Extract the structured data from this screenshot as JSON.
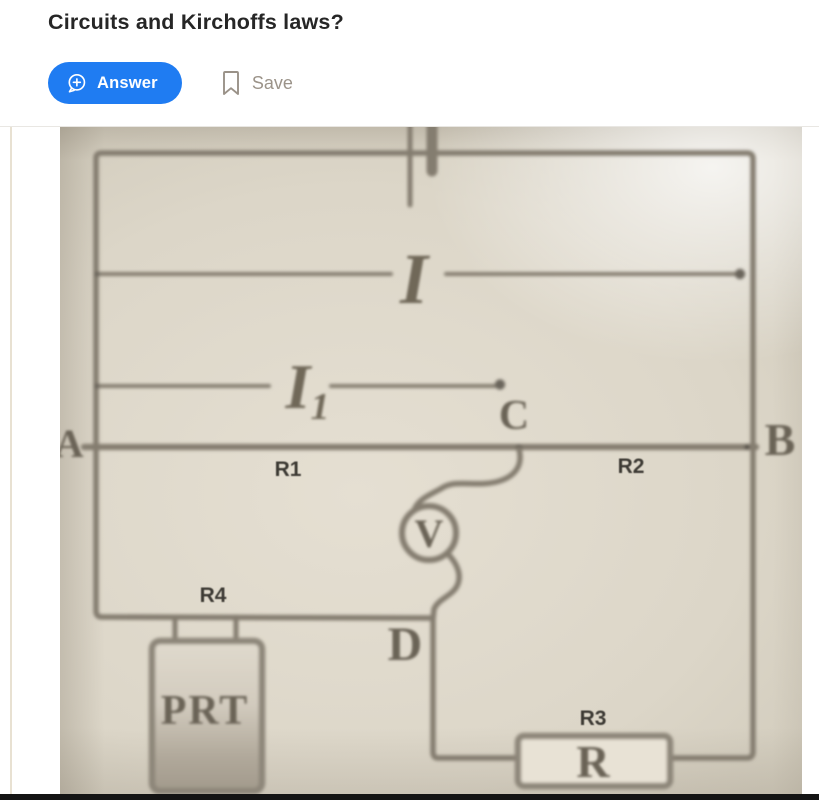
{
  "question": {
    "title": "Circuits and Kirchoffs laws?"
  },
  "actions": {
    "answer_label": "Answer",
    "save_label": "Save"
  },
  "colors": {
    "accent_blue": "#1f7cf2",
    "save_gray": "#9b9389",
    "photo_background": "#ddd7c9",
    "wire_gray": "#847d70",
    "handwriting_ink": "#6a6356",
    "printed_label_ink": "#3d3a34",
    "bottom_bar_black": "#141414"
  },
  "circuit": {
    "nodes": {
      "a": "A",
      "b": "B",
      "c": "C",
      "d": "D"
    },
    "currents": {
      "main": "I",
      "branch_main": "I",
      "branch_sub": "1"
    },
    "voltmeter": "V",
    "labels": {
      "r1": "R1",
      "r2": "R2",
      "r3": "R3",
      "r4": "R4"
    },
    "r3_body_letter": "R",
    "sensor_text": "PRT"
  }
}
